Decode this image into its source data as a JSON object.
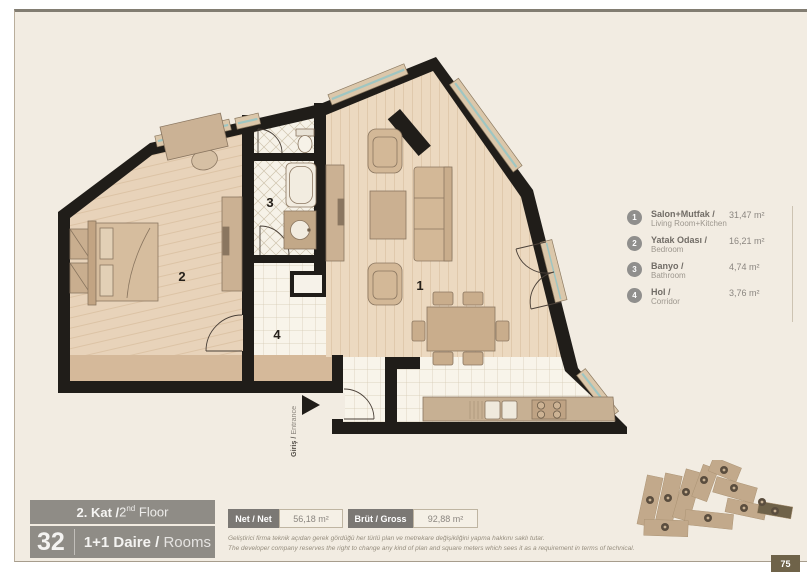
{
  "plan": {
    "room_labels": [
      "1",
      "2",
      "3",
      "4"
    ],
    "entrance_label_tr": "Giriş / ",
    "entrance_label_en": "Entrance"
  },
  "legend": {
    "items": [
      {
        "num": "1",
        "title_tr": "Salon+Mutfak /",
        "title_en": "Living Room+Kitchen",
        "area": "31,47 m²"
      },
      {
        "num": "2",
        "title_tr": "Yatak Odası /",
        "title_en": "Bedroom",
        "area": "16,21 m²"
      },
      {
        "num": "3",
        "title_tr": "Banyo /",
        "title_en": "Bathroom",
        "area": "4,74 m²"
      },
      {
        "num": "4",
        "title_tr": "Hol /",
        "title_en": "Corridor",
        "area": "3,76 m²"
      }
    ]
  },
  "floor_block": {
    "floor_tr": "2. Kat / ",
    "floor_num_en": "2",
    "floor_sup_en": "nd",
    "floor_rest_en": " Floor",
    "unit_number": "32",
    "unit_tr": "1+1 Daire / ",
    "unit_en": "Rooms"
  },
  "metrics": {
    "net_label": "Net / Net",
    "net_value": "56,18 m²",
    "gross_label": "Brüt / Gross",
    "gross_value": "92,88 m²"
  },
  "disclaimer": {
    "tr": "Geliştirici firma teknik açıdan gerek gördüğü her türlü plan ve metrekare değişikliğini yapma hakkını saklı tutar.",
    "en": "The developer company reserves the right to change any kind of plan and square meters which sees it as a requirement in terms of technical."
  },
  "page_number": "75",
  "colors": {
    "wall": "#201d19",
    "glass": "#9fc6c2",
    "bar_gray": "#8f8c86",
    "accent_dark": "#6f6349"
  }
}
